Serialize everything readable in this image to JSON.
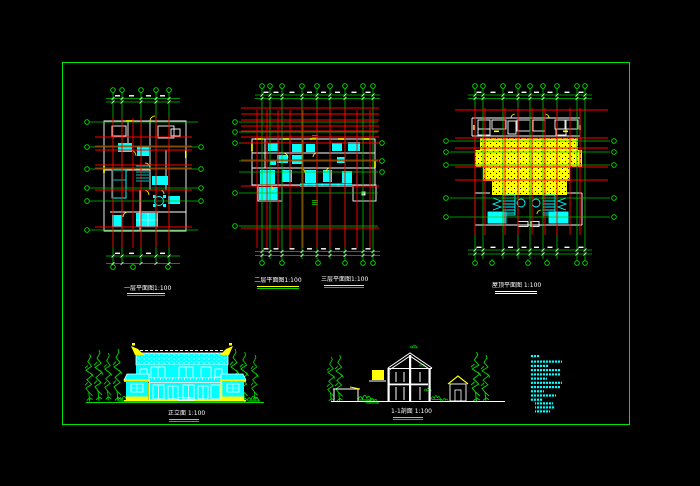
{
  "drawing": {
    "type": "architectural-cad-sheet",
    "background": "#000000",
    "border_color": "#00e400"
  },
  "colors": {
    "grid_green": "#00c400",
    "bubble_green": "#00e400",
    "axis_red": "#ff0000",
    "wall_white": "#ffffff",
    "furniture_cyan": "#00ffff",
    "accent_yellow": "#ffff00",
    "tree_green": "#00dd00",
    "notes_cyan": "#00ffff"
  },
  "titles": {
    "plan1": "一层平面图1:100",
    "plan2a": "二层平面图1:100",
    "plan2b": "三层平面图1:100",
    "plan3": "屋顶平面图 1:100",
    "elevation": "正立面 1:100",
    "section": "1-1剖面 1:100"
  },
  "plans": {
    "plan1": {
      "top_x": [
        113,
        122,
        141,
        156,
        169
      ],
      "top_bubble_y": 90,
      "bottom_x": [
        113,
        133,
        168
      ],
      "bottom_bubble_y": 267,
      "v_y1": 97,
      "v_y2": 263,
      "dim_top_y": [
        98.5,
        102
      ],
      "dim_bottom_y": [
        256,
        263.5
      ],
      "dim_x1": 106,
      "dim_x2": 180,
      "left_x": 87,
      "left_y": [
        122,
        147,
        169,
        188,
        201,
        230
      ],
      "right_x": 201,
      "right_y": [
        147,
        169,
        188,
        201
      ],
      "h_x1": 90,
      "h_x2": 198,
      "red_v": [
        113,
        122,
        133,
        141,
        156,
        169
      ],
      "red_v_y1": 118,
      "red_v_y2": 248,
      "red_h": [
        137,
        146,
        150,
        165,
        168,
        190,
        227
      ],
      "red_h_x1": 95,
      "red_h_x2": 192
    },
    "plan2": {
      "top_x": [
        262,
        270,
        282,
        302,
        317,
        330,
        345,
        363,
        373
      ],
      "top_bubble_y": 86,
      "bottom_x": [
        262,
        282,
        318,
        345,
        363,
        373
      ],
      "bottom_bubble_y": 263,
      "v_y1": 93,
      "v_y2": 259,
      "dim_top_y": [
        95,
        98.5
      ],
      "dim_bottom_y": [
        251.5,
        255.5
      ],
      "dim_x1": 255,
      "dim_x2": 380,
      "left_x": 235,
      "left_y": [
        122,
        132,
        143,
        193,
        226
      ],
      "right_x": 382,
      "right_y": [
        143,
        161,
        172
      ],
      "h_x1": 239,
      "h_x2": 378,
      "red_v": [
        257,
        267,
        278,
        290,
        303,
        317,
        330,
        345,
        357,
        370
      ],
      "red_v_y1": 110,
      "red_v_y2": 248,
      "red_h": [
        108,
        114,
        120,
        126,
        131,
        137,
        143,
        160,
        186,
        228
      ],
      "red_h_x1": 241,
      "red_h_x2": 379
    },
    "plan3": {
      "top_x": [
        475,
        483,
        503,
        518,
        530,
        543,
        557,
        577,
        585
      ],
      "top_bubble_y": 86,
      "bottom_x": [
        475,
        492,
        528,
        547,
        577,
        585
      ],
      "bottom_bubble_y": 263,
      "v_y1": 93,
      "v_y2": 259,
      "dim_top_y": [
        95,
        98.5
      ],
      "dim_bottom_y": [
        250,
        254
      ],
      "dim_x1": 468,
      "dim_x2": 592,
      "left_x": 446,
      "left_y": [
        141,
        152,
        165,
        198,
        217
      ],
      "right_x": 614,
      "right_y": [
        141,
        152,
        165,
        198,
        217
      ],
      "h_x1": 450,
      "h_x2": 610,
      "red_v": [
        475,
        485,
        505,
        518,
        532,
        545,
        557,
        570,
        580
      ],
      "red_v_y1": 108,
      "red_v_y2": 235,
      "red_h": [
        110,
        138,
        148,
        167,
        180
      ],
      "red_h_x1": 455,
      "red_h_x2": 608
    }
  },
  "notes": {
    "lines": [
      {
        "x": 530,
        "y": 355,
        "w": 10
      },
      {
        "x": 530,
        "y": 360.5,
        "w": 32
      },
      {
        "x": 530,
        "y": 364.8,
        "w": 19
      },
      {
        "x": 530,
        "y": 369,
        "w": 31
      },
      {
        "x": 530,
        "y": 373.3,
        "w": 30
      },
      {
        "x": 530,
        "y": 377.5,
        "w": 17
      },
      {
        "x": 530,
        "y": 381.7,
        "w": 32
      },
      {
        "x": 530,
        "y": 386,
        "w": 30
      },
      {
        "x": 530,
        "y": 390.2,
        "w": 14
      },
      {
        "x": 530,
        "y": 394.4,
        "w": 26
      },
      {
        "x": 530,
        "y": 398.6,
        "w": 13
      },
      {
        "x": 535,
        "y": 402.3,
        "w": 18
      },
      {
        "x": 535,
        "y": 406.3,
        "w": 20
      },
      {
        "x": 535,
        "y": 410.3,
        "w": 15
      }
    ]
  }
}
